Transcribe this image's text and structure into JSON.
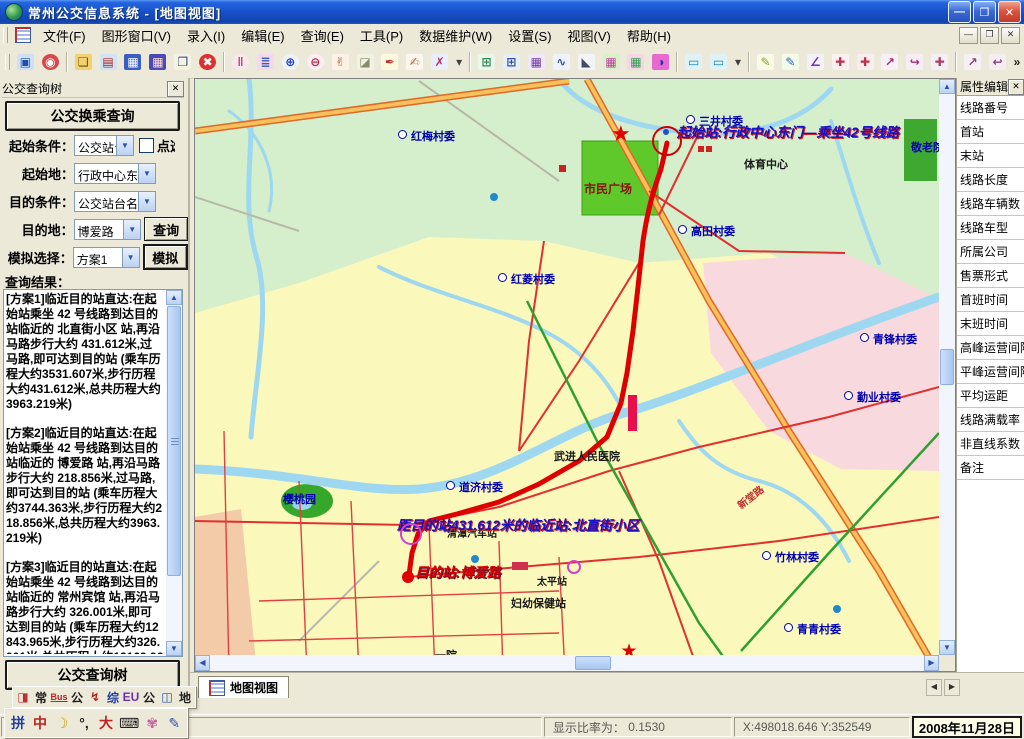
{
  "window": {
    "title": "常州公交信息系统 - [地图视图]",
    "buttons": {
      "minimize": "—",
      "restore": "❐",
      "close": "✕"
    }
  },
  "menu": {
    "items": [
      "文件(F)",
      "图形窗口(V)",
      "录入(I)",
      "编辑(E)",
      "查询(E)",
      "工具(P)",
      "数据维护(W)",
      "设置(S)",
      "视图(V)",
      "帮助(H)"
    ]
  },
  "toolbar": {
    "buttons": [
      {
        "n": "map-window-icon",
        "g": "▣",
        "fg": "#1F4FAE",
        "bg": "#CFE0F6"
      },
      {
        "n": "record-view-icon",
        "g": "◉",
        "fg": "#FFFFFF",
        "bg": "#D84848",
        "round": true
      },
      {
        "sep": true
      },
      {
        "n": "open-folder-icon",
        "g": "❏",
        "fg": "#6A5210",
        "bg": "#F2D270"
      },
      {
        "n": "edit-data-icon",
        "g": "▤",
        "fg": "#B02020",
        "bg": "#CFE4F2"
      },
      {
        "n": "save-icon",
        "g": "▦",
        "fg": "#FFFFFF",
        "bg": "#3A5FC0"
      },
      {
        "n": "save-all-icon",
        "g": "▦",
        "fg": "#FFD8D8",
        "bg": "#4A4AB0"
      },
      {
        "n": "new-window-icon",
        "g": "❐",
        "fg": "#2A4A9A",
        "bg": "#F6F2E2"
      },
      {
        "n": "close-doc-icon",
        "g": "✖",
        "fg": "#FFFFFF",
        "bg": "#DD3030",
        "round": true
      },
      {
        "sep": true
      },
      {
        "n": "pause-refresh-icon",
        "g": "‖",
        "fg": "#C04868",
        "bg": "#F8E8EC",
        "round": true
      },
      {
        "n": "layers-icon",
        "g": "≣",
        "fg": "#3858C0",
        "bg": "#F4D8EC"
      },
      {
        "n": "zoom-in-icon",
        "g": "⊕",
        "fg": "#2040C0",
        "bg": "#EEF2FC",
        "round": true
      },
      {
        "n": "zoom-out-icon",
        "g": "⊖",
        "fg": "#C02040",
        "bg": "#FCEEF2",
        "round": true
      },
      {
        "n": "pan-hand-icon",
        "g": "✌",
        "fg": "#B06030",
        "bg": "#FDF2E6"
      },
      {
        "n": "eraser-icon",
        "g": "◪",
        "fg": "#8A8A6A",
        "bg": "#F2F2E2"
      },
      {
        "n": "identify-icon",
        "g": "✒",
        "fg": "#C03030",
        "bg": "#FCF8DC"
      },
      {
        "n": "select-hand-icon",
        "g": "✍",
        "fg": "#A87848",
        "bg": "#FDF6EE"
      },
      {
        "n": "clear-selection-icon",
        "g": "✗",
        "fg": "#B03060",
        "bg": "#E8EEFC"
      },
      {
        "n": "zoom-dropdown-arrow",
        "g": "▾",
        "fg": "#404040",
        "bg": "transparent",
        "narrow": true
      },
      {
        "sep": true
      },
      {
        "n": "grid-edit-icon",
        "g": "⊞",
        "fg": "#2E8B50",
        "bg": "#EAF6EA"
      },
      {
        "n": "grid-view-icon",
        "g": "⊞",
        "fg": "#3050B0",
        "bg": "#E8EEF8"
      },
      {
        "n": "stats-table-icon",
        "g": "▦",
        "fg": "#7040A0",
        "bg": "#F0E8F8"
      },
      {
        "n": "chart-icon",
        "g": "∿",
        "fg": "#3050B0",
        "bg": "#EEF2FA"
      },
      {
        "n": "slope-ruler-icon",
        "g": "◣",
        "fg": "#405060",
        "bg": "#F2F4F8"
      },
      {
        "n": "thematic-map-icon",
        "g": "▦",
        "fg": "#C040A0",
        "bg": "#D6F2C6"
      },
      {
        "n": "thematic-map2-icon",
        "g": "▦",
        "fg": "#30A050",
        "bg": "#F6D6E6"
      },
      {
        "n": "thematic-map3-icon",
        "g": "◑",
        "fg": "#2030B0",
        "bg": "#E86AD0"
      },
      {
        "sep": true
      },
      {
        "n": "measure-length-icon",
        "g": "▭",
        "fg": "#1888A8",
        "bg": "#DEF2F8"
      },
      {
        "n": "measure-area-icon",
        "g": "▭",
        "fg": "#1888A8",
        "bg": "#DEF2F8"
      },
      {
        "n": "measure-dropdown-arrow",
        "g": "▾",
        "fg": "#404040",
        "bg": "transparent",
        "narrow": true
      },
      {
        "sep": true
      },
      {
        "n": "draw-pencil-icon",
        "g": "✎",
        "fg": "#90A020",
        "bg": "#FAFAE8"
      },
      {
        "n": "draw-polyline-icon",
        "g": "✎",
        "fg": "#3060C0",
        "bg": "#F2FAE8"
      },
      {
        "n": "edit-vertex-icon",
        "g": "∠",
        "fg": "#7030C0",
        "bg": "#F4F0FA"
      },
      {
        "n": "add-vertex-icon",
        "g": "✚",
        "fg": "#C03048",
        "bg": "#FAF0F2"
      },
      {
        "n": "delete-vertex-icon",
        "g": "✚",
        "fg": "#C03048",
        "bg": "#F8EEF0"
      },
      {
        "n": "move-vertex-icon",
        "g": "↗",
        "fg": "#A03078",
        "bg": "#F8F0F6"
      },
      {
        "n": "rotate-feature-icon",
        "g": "↪",
        "fg": "#A03078",
        "bg": "#F6EEF4"
      },
      {
        "n": "split-feature-icon",
        "g": "✚",
        "fg": "#B04060",
        "bg": "#F4EEF6"
      },
      {
        "sep": true
      },
      {
        "n": "snap-next-icon",
        "g": "↗",
        "fg": "#904070",
        "bg": "#F6F0F4"
      },
      {
        "n": "snap-prev-icon",
        "g": "↩",
        "fg": "#904070",
        "bg": "#F4EEF2"
      },
      {
        "n": "toolbar-overflow-chevron",
        "g": "»",
        "fg": "#202020",
        "bg": "transparent",
        "narrow": true
      }
    ]
  },
  "left_panel": {
    "title": "公交查询树",
    "close_glyph": "✕",
    "transfer_button": "公交换乘查询",
    "form": {
      "rows": [
        {
          "label": "起始条件：",
          "value": "公交站台名",
          "checkbox_label": "点选"
        },
        {
          "label": "起始地：",
          "value": "行政中心东门"
        },
        {
          "label": "目的条件：",
          "value": "公交站台名"
        },
        {
          "label": "目的地：",
          "value": "博爱路",
          "button": "查询"
        },
        {
          "label": "模拟选择：",
          "value": "方案1",
          "button": "模拟"
        }
      ]
    },
    "results_label": "查询结果：",
    "results_paragraphs": [
      "[方案1]临近目的站直达:在起始站乘坐 42 号线路到达目的站临近的 北直街小区 站,再沿马路步行大约 431.612米,过马路,即可达到目的站      (乘车历程大约3531.607米,步行历程大约431.612米,总共历程大约3963.219米)",
      "[方案2]临近目的站直达:在起始站乘坐 42 号线路到达目的站临近的 博爱路 站,再沿马路步行大约 218.856米,过马路,即可达到目的站   (乘车历程大约3744.363米,步行历程大约218.856米,总共历程大约3963.219米)",
      "[方案3]临近目的站直达:在起始站乘坐 42 号线路到达目的站临近的 常州宾馆 站,再沿马路步行大约 326.001米,即可达到目的站       (乘车历程大约12843.965米,步行历程大约326.001米,总共历程大约13169.966米)",
      "[方案4]直达:在起始站乘坐 42 号线路可直达目的站.        ("
    ],
    "bottom_button": "公交查询树"
  },
  "right_panel": {
    "title": "属性编辑",
    "close_glyph": "✕",
    "rows": [
      "线路番号",
      "首站",
      "末站",
      "线路长度",
      "线路车辆数",
      "线路车型",
      "所属公司",
      "售票形式",
      "首班时间",
      "末班时间",
      "高峰运营间隔",
      "平峰运营间隔",
      "平均运距",
      "线路满载率",
      "非直线系数",
      "备注"
    ]
  },
  "map": {
    "colors": {
      "route": "#DE0000",
      "major_road": "#F6C05A",
      "road_casing": "#E06828",
      "minor_road": "#E03030",
      "water": "#9ED8F0",
      "green_area": "#D5EFCC",
      "yellow_area": "#FBF8BC",
      "pink_area": "#F8D9DD",
      "salmon_area": "#F3CBA8",
      "plaza_green": "#5FC82A",
      "railway": "#2FA030"
    },
    "labels": [
      {
        "t": "三井村委",
        "x": 700,
        "y": 112,
        "c": "v",
        "poi": true
      },
      {
        "t": "红梅村委",
        "x": 412,
        "y": 127,
        "c": "v",
        "poi": true
      },
      {
        "t": "市民广场",
        "x": 585,
        "y": 179,
        "c": "plaza"
      },
      {
        "t": "体育中心",
        "x": 745,
        "y": 155,
        "c": "k"
      },
      {
        "t": "敬老院",
        "x": 912,
        "y": 138,
        "c": "v"
      },
      {
        "t": "高田村委",
        "x": 692,
        "y": 222,
        "c": "v",
        "poi": true
      },
      {
        "t": "红菱村委",
        "x": 512,
        "y": 270,
        "c": "v",
        "poi": true
      },
      {
        "t": "青锋村委",
        "x": 874,
        "y": 330,
        "c": "v",
        "poi": true
      },
      {
        "t": "勤业村委",
        "x": 858,
        "y": 388,
        "c": "v",
        "poi": true
      },
      {
        "t": "武进人民医院",
        "x": 555,
        "y": 447,
        "c": "k"
      },
      {
        "t": "道济村委",
        "x": 460,
        "y": 478,
        "c": "v",
        "poi": true
      },
      {
        "t": "樱桃园",
        "x": 284,
        "y": 490,
        "c": "v"
      },
      {
        "t": "清潭汽车站",
        "x": 448,
        "y": 524,
        "c": "k2"
      },
      {
        "t": "太平站",
        "x": 538,
        "y": 572,
        "c": "k2"
      },
      {
        "t": "妇幼保健站",
        "x": 512,
        "y": 594,
        "c": "k"
      },
      {
        "t": "一院",
        "x": 436,
        "y": 646,
        "c": "k"
      },
      {
        "t": "竹林村委",
        "x": 776,
        "y": 548,
        "c": "v",
        "poi": true
      },
      {
        "t": "青青村委",
        "x": 798,
        "y": 620,
        "c": "v",
        "poi": true
      },
      {
        "t": "新堂路",
        "x": 736,
        "y": 488,
        "c": "road",
        "rot": -38
      },
      {
        "t": "起始站:行政中心东门—乘坐42号线路",
        "x": 678,
        "y": 120,
        "c": "ann"
      },
      {
        "t": "距目的站431.612米的临近站:北直街小区",
        "x": 398,
        "y": 513,
        "c": "ann"
      },
      {
        "t": "目的站:博爱路",
        "x": 416,
        "y": 560,
        "c": "dest"
      }
    ],
    "markers": [
      {
        "t": "star",
        "x": 623,
        "y": 133,
        "s": 22
      },
      {
        "t": "star",
        "x": 631,
        "y": 650,
        "s": 19
      },
      {
        "t": "ring",
        "x": 668,
        "y": 140,
        "r": 15,
        "c": "#D00000",
        "w": 2
      },
      {
        "t": "ring",
        "x": 412,
        "y": 533,
        "r": 11,
        "c": "#D040D0",
        "w": 2
      },
      {
        "t": "ring",
        "x": 575,
        "y": 566,
        "r": 7,
        "c": "#D040D0",
        "w": 2
      },
      {
        "t": "dot",
        "x": 409,
        "y": 576,
        "r": 6,
        "c": "#E00000"
      },
      {
        "t": "dot",
        "x": 667,
        "y": 131,
        "r": 3,
        "c": "#2053C8"
      },
      {
        "t": "dot",
        "x": 495,
        "y": 196,
        "r": 4,
        "c": "#2288CC"
      },
      {
        "t": "dot",
        "x": 838,
        "y": 608,
        "r": 4,
        "c": "#2288CC"
      },
      {
        "t": "dot",
        "x": 476,
        "y": 558,
        "r": 4,
        "c": "#2288CC"
      },
      {
        "t": "rect",
        "x": 629,
        "y": 394,
        "w": 9,
        "h": 36,
        "c": "#E8104C"
      },
      {
        "t": "rect",
        "x": 513,
        "y": 561,
        "w": 16,
        "h": 8,
        "c": "#D03050"
      },
      {
        "t": "rect",
        "x": 699,
        "y": 145,
        "w": 6,
        "h": 6,
        "c": "#D02020"
      },
      {
        "t": "rect",
        "x": 707,
        "y": 145,
        "w": 6,
        "h": 6,
        "c": "#D02020"
      },
      {
        "t": "rect",
        "x": 560,
        "y": 164,
        "w": 7,
        "h": 7,
        "c": "#CC2222"
      }
    ]
  },
  "bottom_bar": {
    "tab": "地图视图",
    "left_arrow": "◀",
    "right_arrow": "▶"
  },
  "mini_toolbar": {
    "buttons": [
      {
        "g": "◨",
        "n": "layer-source-icon",
        "fg": "#C03030"
      },
      {
        "g": "常",
        "n": "layer-chang-button",
        "fg": "#202020"
      },
      {
        "g": "Bus",
        "n": "layer-bus-button",
        "fg": "#C02020"
      },
      {
        "g": "公",
        "n": "layer-gong-button",
        "fg": "#202020"
      },
      {
        "g": "↯",
        "n": "layer-color-button",
        "fg": "#C02020"
      },
      {
        "g": "综",
        "n": "layer-zong-button",
        "fg": "#2040A0"
      },
      {
        "g": "EU",
        "n": "layer-eu-button",
        "fg": "#7030B0"
      },
      {
        "g": "公",
        "n": "layer-gong2-button",
        "fg": "#202020"
      },
      {
        "g": "◫",
        "n": "layer-screen-button",
        "fg": "#2050B0"
      },
      {
        "g": "地",
        "n": "layer-di-button",
        "fg": "#202020"
      }
    ]
  },
  "ime_bar": {
    "buttons": [
      {
        "g": "拼",
        "n": "ime-brand-icon",
        "fg": "#2040A0"
      },
      {
        "g": "中",
        "n": "ime-lang-toggle",
        "fg": "#C02020"
      },
      {
        "g": "☽",
        "n": "ime-width-toggle",
        "fg": "#C8A000"
      },
      {
        "g": "°,",
        "n": "ime-punct-toggle",
        "fg": "#202020"
      },
      {
        "g": "大",
        "n": "ime-dict-icon",
        "fg": "#C02020"
      },
      {
        "g": "⌨",
        "n": "ime-softkeyboard-icon",
        "fg": "#202020"
      },
      {
        "g": "✾",
        "n": "ime-tools-icon",
        "fg": "#C060A0"
      },
      {
        "g": "✎",
        "n": "ime-notes-icon",
        "fg": "#3050B0"
      }
    ]
  },
  "status_bar": {
    "ratio_label": "显示比率为：",
    "ratio_value": "0.1530",
    "coords": "X:498018.646 Y:352549",
    "date": "2008年11月28日"
  }
}
